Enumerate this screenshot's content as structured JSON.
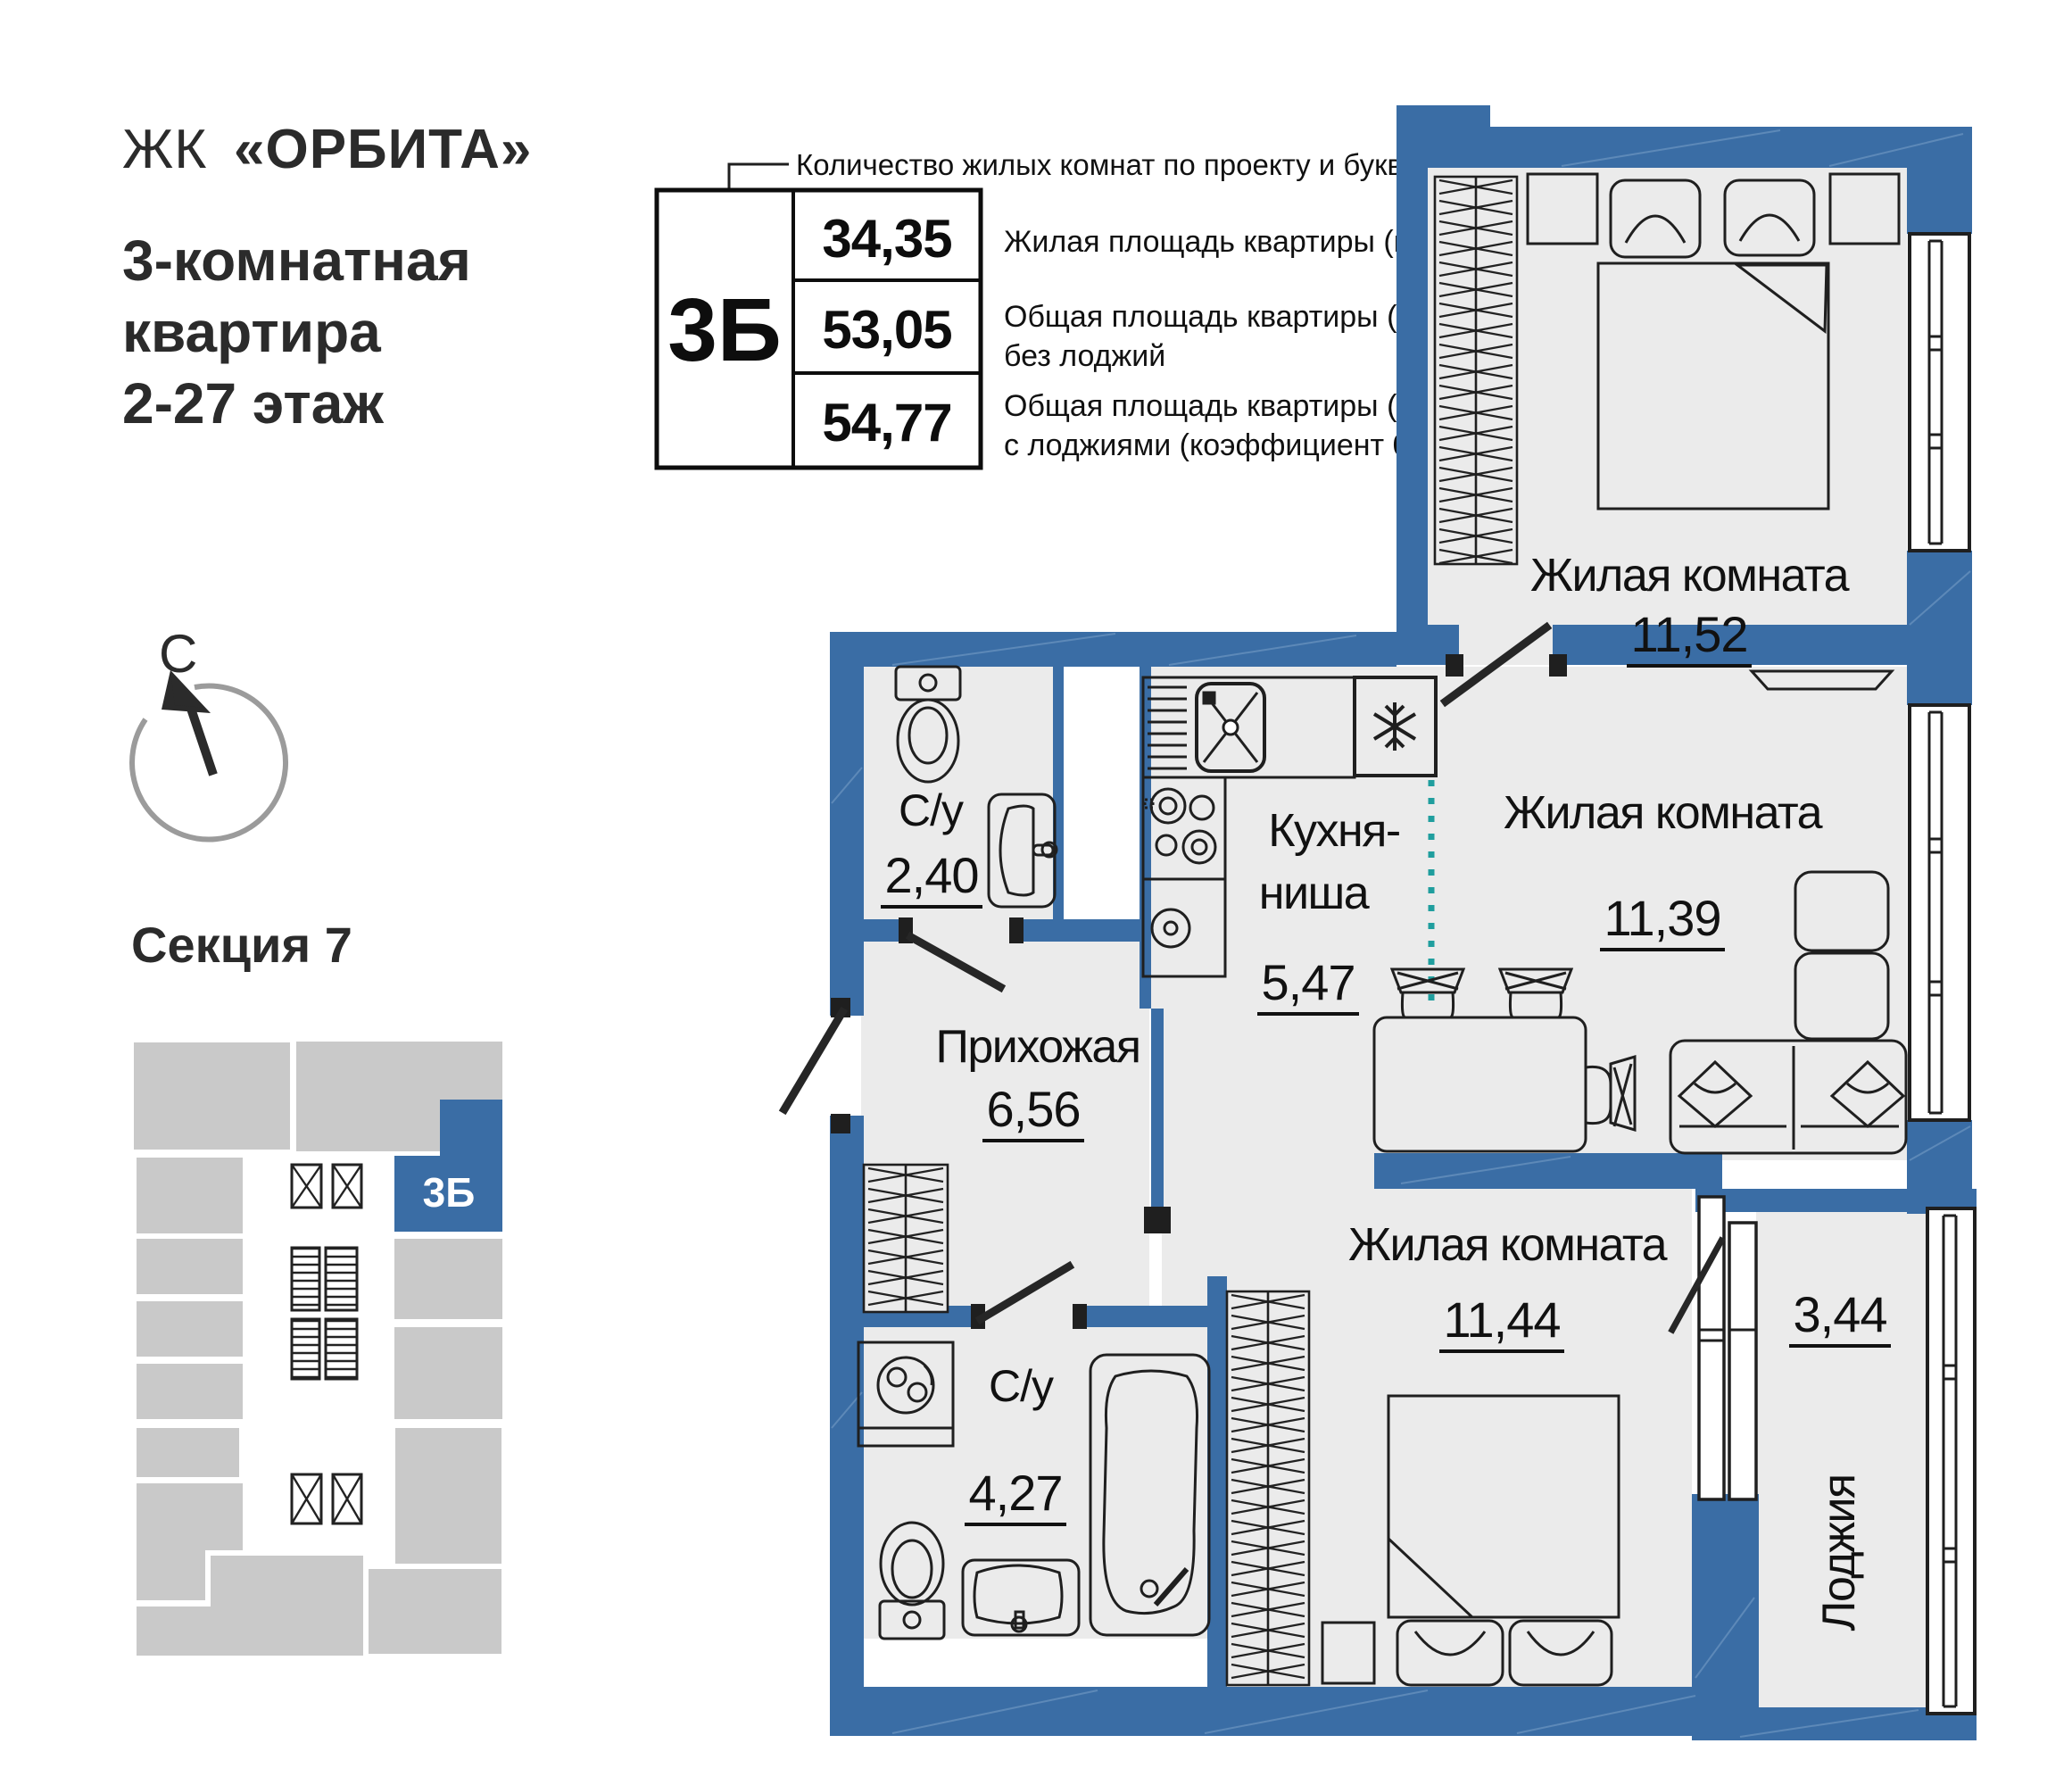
{
  "header": {
    "brand_prefix": "ЖК",
    "brand_name": "«ОРБИТА»",
    "apartment_line1": "3-комнатная",
    "apartment_line2": "квартира",
    "apartment_line3": "2-27 этаж"
  },
  "legend": {
    "callout": "Количество жилых комнат по проекту и буквенный код",
    "unit_code": "3Б",
    "rows": [
      {
        "value": "34,35",
        "label1": "Жилая площадь квартиры (кв.м)",
        "label2": ""
      },
      {
        "value": "53,05",
        "label1": "Общая площадь квартиры (кв.м)",
        "label2": "без лоджий"
      },
      {
        "value": "54,77",
        "label1": "Общая площадь квартиры (кв.м)",
        "label2": "с лоджиями (коэффициент 0,5)"
      }
    ]
  },
  "compass": {
    "north_label": "С"
  },
  "section_map": {
    "title": "Секция 7",
    "unit_code": "3Б"
  },
  "plan": {
    "rooms": [
      {
        "name": "Жилая комната",
        "area": "11,52"
      },
      {
        "name": "Жилая комната",
        "area": "11,39"
      },
      {
        "name_line1": "Кухня-",
        "name_line2": "ниша",
        "area": "5,47"
      },
      {
        "name": "С/у",
        "area": "2,40"
      },
      {
        "name": "Прихожая",
        "area": "6,56"
      },
      {
        "name": "Жилая комната",
        "area": "11,44"
      },
      {
        "name": "С/у",
        "area": "4,27"
      },
      {
        "name": "Лоджия",
        "area": "3,44"
      }
    ]
  },
  "icons": {
    "compass-arrow-icon": "north direction arrow",
    "elevator-icon": "crossed box",
    "stairs-icon": "hatched box",
    "wardrobe-icon": "hatched closet strip",
    "bed-icon": "double bed with pillows",
    "sofa-icon": "corner sofa",
    "dining-table-icon": "table with chairs",
    "stove-icon": "4-burner hob",
    "kitchen-sink-icon": "sink with cross",
    "fridge-icon": "snowflake box",
    "toilet-icon": "toilet",
    "washbasin-icon": "basin",
    "bathtub-icon": "bathtub",
    "washer-icon": "washing machine"
  },
  "colors": {
    "wall_blue": "#3a6da5",
    "floor_gray": "#ebebeb",
    "divider_teal": "#1f9e9e",
    "map_gray": "#c9c9c9",
    "line_black": "#1f1f1f"
  }
}
